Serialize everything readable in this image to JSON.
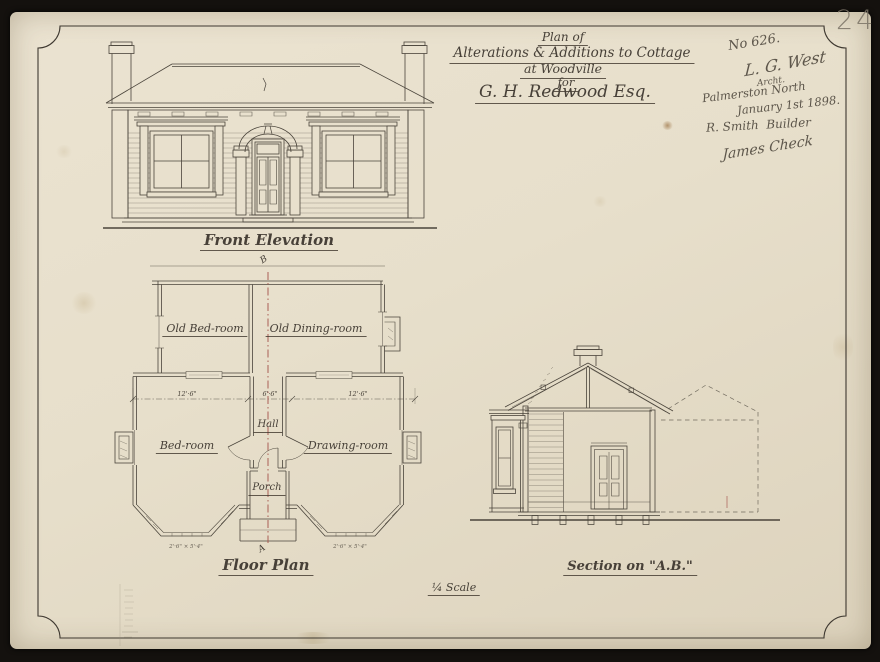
{
  "page": {
    "number": "24"
  },
  "title": {
    "l1": "Plan of",
    "l2": "Alterations & Additions to Cottage",
    "l3": "at Woodville",
    "l4": "for",
    "l5": "G. H. Redwood Esq."
  },
  "notes": {
    "job_number": "No 626.",
    "signature": "L. G. West",
    "signature_title": "Archt.",
    "place": "Palmerston North",
    "date": "January 1st 1898.",
    "builder": "R. Smith  Builder",
    "approval": "James Check"
  },
  "elevation": {
    "caption": "Front Elevation"
  },
  "plan": {
    "caption": "Floor Plan",
    "old_bedroom": "Old Bed-room",
    "old_dining": "Old Dining-room",
    "hall": "Hall",
    "bedroom": "Bed-room",
    "drawing_room": "Drawing-room",
    "porch": "Porch",
    "dim_left": "12'·6\"",
    "dim_hall": "6'·6\"",
    "dim_right": "12'·6\"",
    "bay_dim": "2'·6\" × 5'·4\"",
    "mark_top": "B",
    "mark_bottom": "A"
  },
  "section": {
    "caption": "Section on \"A.B.\""
  },
  "scale": {
    "caption": "¼ Scale"
  }
}
